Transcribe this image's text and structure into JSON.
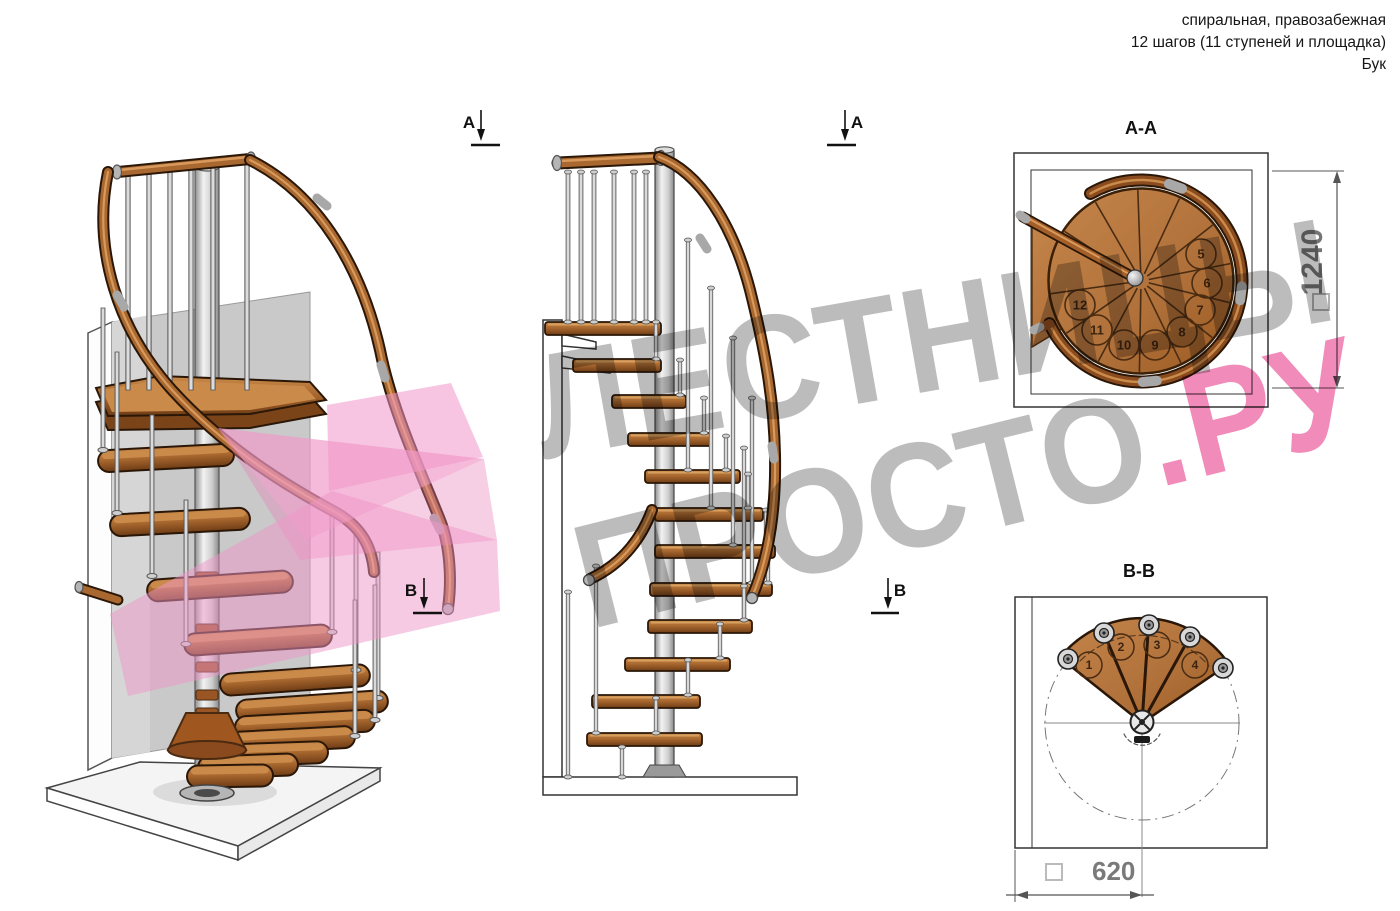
{
  "header": {
    "line1": "спиральная, правозабежная",
    "line2": "12 шагов (11 ступеней и площадка)",
    "line3": "Бук"
  },
  "watermark": {
    "line1": "ЛЕСТНИЦЫ",
    "line2_gray": "ПРОСТО",
    "line2_pink": ".РУ"
  },
  "markers": {
    "a": "A",
    "b": "B"
  },
  "sections": {
    "aa": {
      "title": "A-A",
      "dimension": "1240",
      "steps": [
        5,
        6,
        7,
        8,
        9,
        10,
        11,
        12
      ]
    },
    "bb": {
      "title": "B-B",
      "dimension": "620",
      "steps": [
        1,
        2,
        3,
        4
      ]
    }
  },
  "colors": {
    "wood": "#a9682f",
    "wood_dark": "#7a4418",
    "outline": "#2a1708",
    "metal": "#c9c9c9",
    "wall_gray": "#cccccc",
    "logo_pink": "#ee82bc",
    "watermark_gray": "#8c8c8c",
    "watermark_pink": "#e83e8c",
    "dimension_gray": "#757575",
    "line": "#333333"
  }
}
